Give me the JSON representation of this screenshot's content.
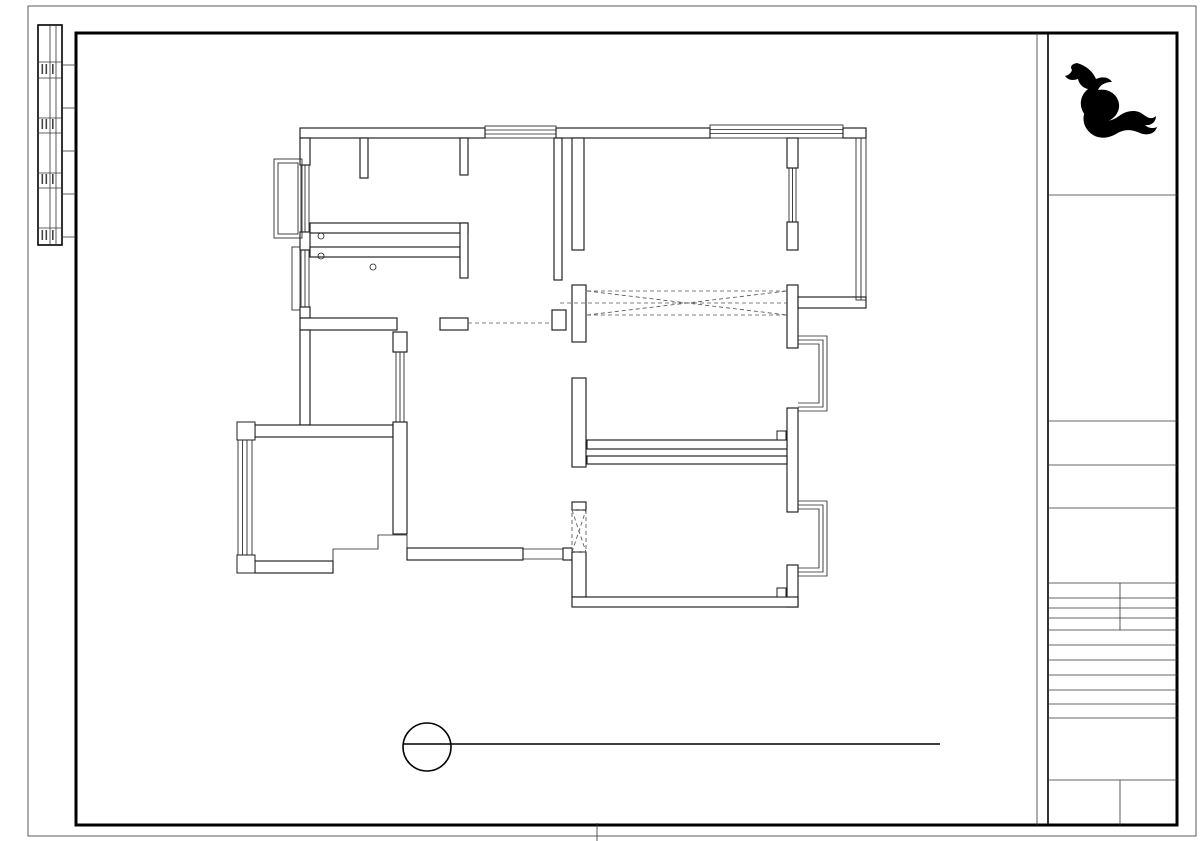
{
  "drawing_title": {
    "code_letter": "P",
    "sheet_no": "PL-888",
    "name_en": "1F PLAN",
    "name_cn": "原始结构图",
    "scale_text": "SCALE: 1:80"
  },
  "frame": {
    "letter_top": {
      "t": "A",
      "x": 105
    },
    "letters_bottom": [
      {
        "t": "A",
        "x": 107
      },
      {
        "t": "D",
        "x": 371
      },
      {
        "t": "E",
        "x": 464
      },
      {
        "t": "F",
        "x": 557
      },
      {
        "t": "G",
        "x": 640
      },
      {
        "t": "H",
        "x": 733
      },
      {
        "t": "J",
        "x": 921
      },
      {
        "t": "K",
        "x": 1002
      }
    ],
    "ticks_bottom": [
      420,
      510,
      689,
      781,
      826,
      872,
      965
    ]
  },
  "plan": {
    "ceiling_height_label": "CH2820",
    "window_tags": [
      {
        "l1": "H1520",
        "l2": "LD1000",
        "x": 296,
        "y": 187
      },
      {
        "l1": "H1520",
        "l2": "LD1000",
        "x": 500,
        "y": 152
      },
      {
        "l1": "H1520",
        "l2": "LD1000",
        "x": 745,
        "y": 182
      },
      {
        "l1": "H1520",
        "l2": "LD1080",
        "x": 821,
        "y": 208
      },
      {
        "l1": "H1520",
        "l2": "LD1000",
        "x": 318,
        "y": 272
      },
      {
        "l1": "H1520",
        "l2": "LD1000",
        "x": 406,
        "y": 374
      },
      {
        "l1": "H1520",
        "l2": "LD1000",
        "x": 745,
        "y": 354
      },
      {
        "l1": "H1520",
        "l2": "LD1000",
        "x": 745,
        "y": 527
      }
    ],
    "level_markers": [
      {
        "text": "-240",
        "tx": 696,
        "ty": 286,
        "ly": 291,
        "lx1": 676,
        "lx2": 717,
        "tri": "679,291 693,291 686,301"
      },
      {
        "text": "-240",
        "tx": 517,
        "ty": 315,
        "ly": 320,
        "lx1": 494,
        "lx2": 558,
        "tri": "497,320 511,320 504,330"
      }
    ],
    "dimensions": {
      "top": {
        "overall": {
          "line": 68,
          "label_pos": 64,
          "ticks": [
            240,
            868
          ],
          "labels": [
            {
              "t": "12990",
              "m": 520
            }
          ]
        },
        "chain": {
          "line": 87,
          "label_pos": 83,
          "ticks": [
            240,
            311.5,
            458.5,
            469.5,
            579,
            590,
            794,
            805,
            868
          ],
          "labels": [
            {
              "t": "1480",
              "m": 276
            },
            {
              "t": "3040",
              "m": 385
            },
            {
              "t": "2270",
              "m": 524
            },
            {
              "t": "4220",
              "m": 692
            },
            {
              "t": "1300",
              "m": 837
            }
          ]
        }
      },
      "bottom": {
        "overall": {
          "line": 676,
          "label_pos": 672,
          "ticks": [
            240,
            868
          ],
          "labels": [
            {
              "t": "12990",
              "m": 520
            }
          ]
        },
        "chain": {
          "line": 655,
          "label_pos": 651,
          "ticks": [
            240,
            311.5,
            391,
            404,
            575,
            588,
            792,
            805,
            868
          ],
          "labels": [
            {
              "t": "1480",
              "m": 276
            },
            {
              "t": "1640",
              "m": 351
            },
            {
              "t": "3540",
              "m": 489
            },
            {
              "t": "4220",
              "m": 690
            },
            {
              "t": "1300",
              "m": 837
            }
          ]
        }
      },
      "left": {
        "overall": {
          "line": 170,
          "label_pos": 164,
          "ticks": [
            128,
            607
          ],
          "labels": [
            {
              "t": "9750",
              "m": 367
            }
          ]
        },
        "chain": {
          "line": 192,
          "label_pos": 186,
          "ticks": [
            128,
            224,
            237,
            313,
            326,
            427.5,
            548,
            560.5,
            607
          ],
          "labels": [
            {
              "t": "1960",
              "m": 176
            },
            {
              "t": "1550",
              "m": 275
            },
            {
              "t": "2070",
              "m": 377
            },
            {
              "t": "2450",
              "m": 487
            },
            {
              "t": "260",
              "m": 554
            },
            {
              "t": "940",
              "m": 584
            }
          ]
        }
      },
      "right": {
        "overall": {
          "line": 930,
          "label_pos": 924,
          "ticks": [
            138,
            607
          ],
          "labels": [
            {
              "t": "9750",
              "m": 372
            }
          ]
        },
        "chain": {
          "line": 908,
          "label_pos": 902,
          "ticks": [
            138,
            287,
            300,
            443.5,
            456.5,
            607
          ],
          "labels": [
            {
              "t": "3100",
              "m": 212
            },
            {
              "t": "2980",
              "m": 372
            },
            {
              "t": "3130",
              "m": 532
            }
          ]
        }
      }
    }
  },
  "title_block": {
    "brand": "红牛装饰",
    "firm": "南京红牛装饰有限公司",
    "addr": "地址：龙蟠中路458号一层",
    "statement": [
      "版权所有 红牛装饰",
      "此方案理解、同意按照本人签字的图纸施工：",
      "客户签字："
    ],
    "rows": [
      {
        "en": "PROJECT TITLE",
        "cn": "项目名称",
        "y": 201
      },
      {
        "en": "DRAWING TITLE",
        "cn": "图名",
        "y": 427
      },
      {
        "en": "CLIENT",
        "cn": "建设单位",
        "y": 471
      },
      {
        "en": "DESIGN FIRM",
        "cn": "设计单位",
        "y": 514
      },
      {
        "en": "PROJECT DIR",
        "cn": "项目负责人",
        "y": 638
      },
      {
        "en": "DESIGNER",
        "cn": "设计师",
        "y": 653
      },
      {
        "en": "DRAWING",
        "cn": "制图人",
        "y": 668
      },
      {
        "en": "CHECKED BY",
        "cn": "审定人",
        "y": 683
      },
      {
        "en": "DATE",
        "cn": "日期",
        "y": 698
      },
      {
        "en": "SCALE",
        "cn": "比例",
        "y": 712
      }
    ],
    "revisions": {
      "en": "REVISIONS",
      "cn": "版本",
      "date_en": "DATE",
      "date_cn": "日期"
    },
    "bottom_row": [
      {
        "en": "Drawing NO",
        "cn": "图号",
        "x": 1053
      },
      {
        "en": "Job NO",
        "cn": "项目编号",
        "x": 1124
      }
    ]
  }
}
